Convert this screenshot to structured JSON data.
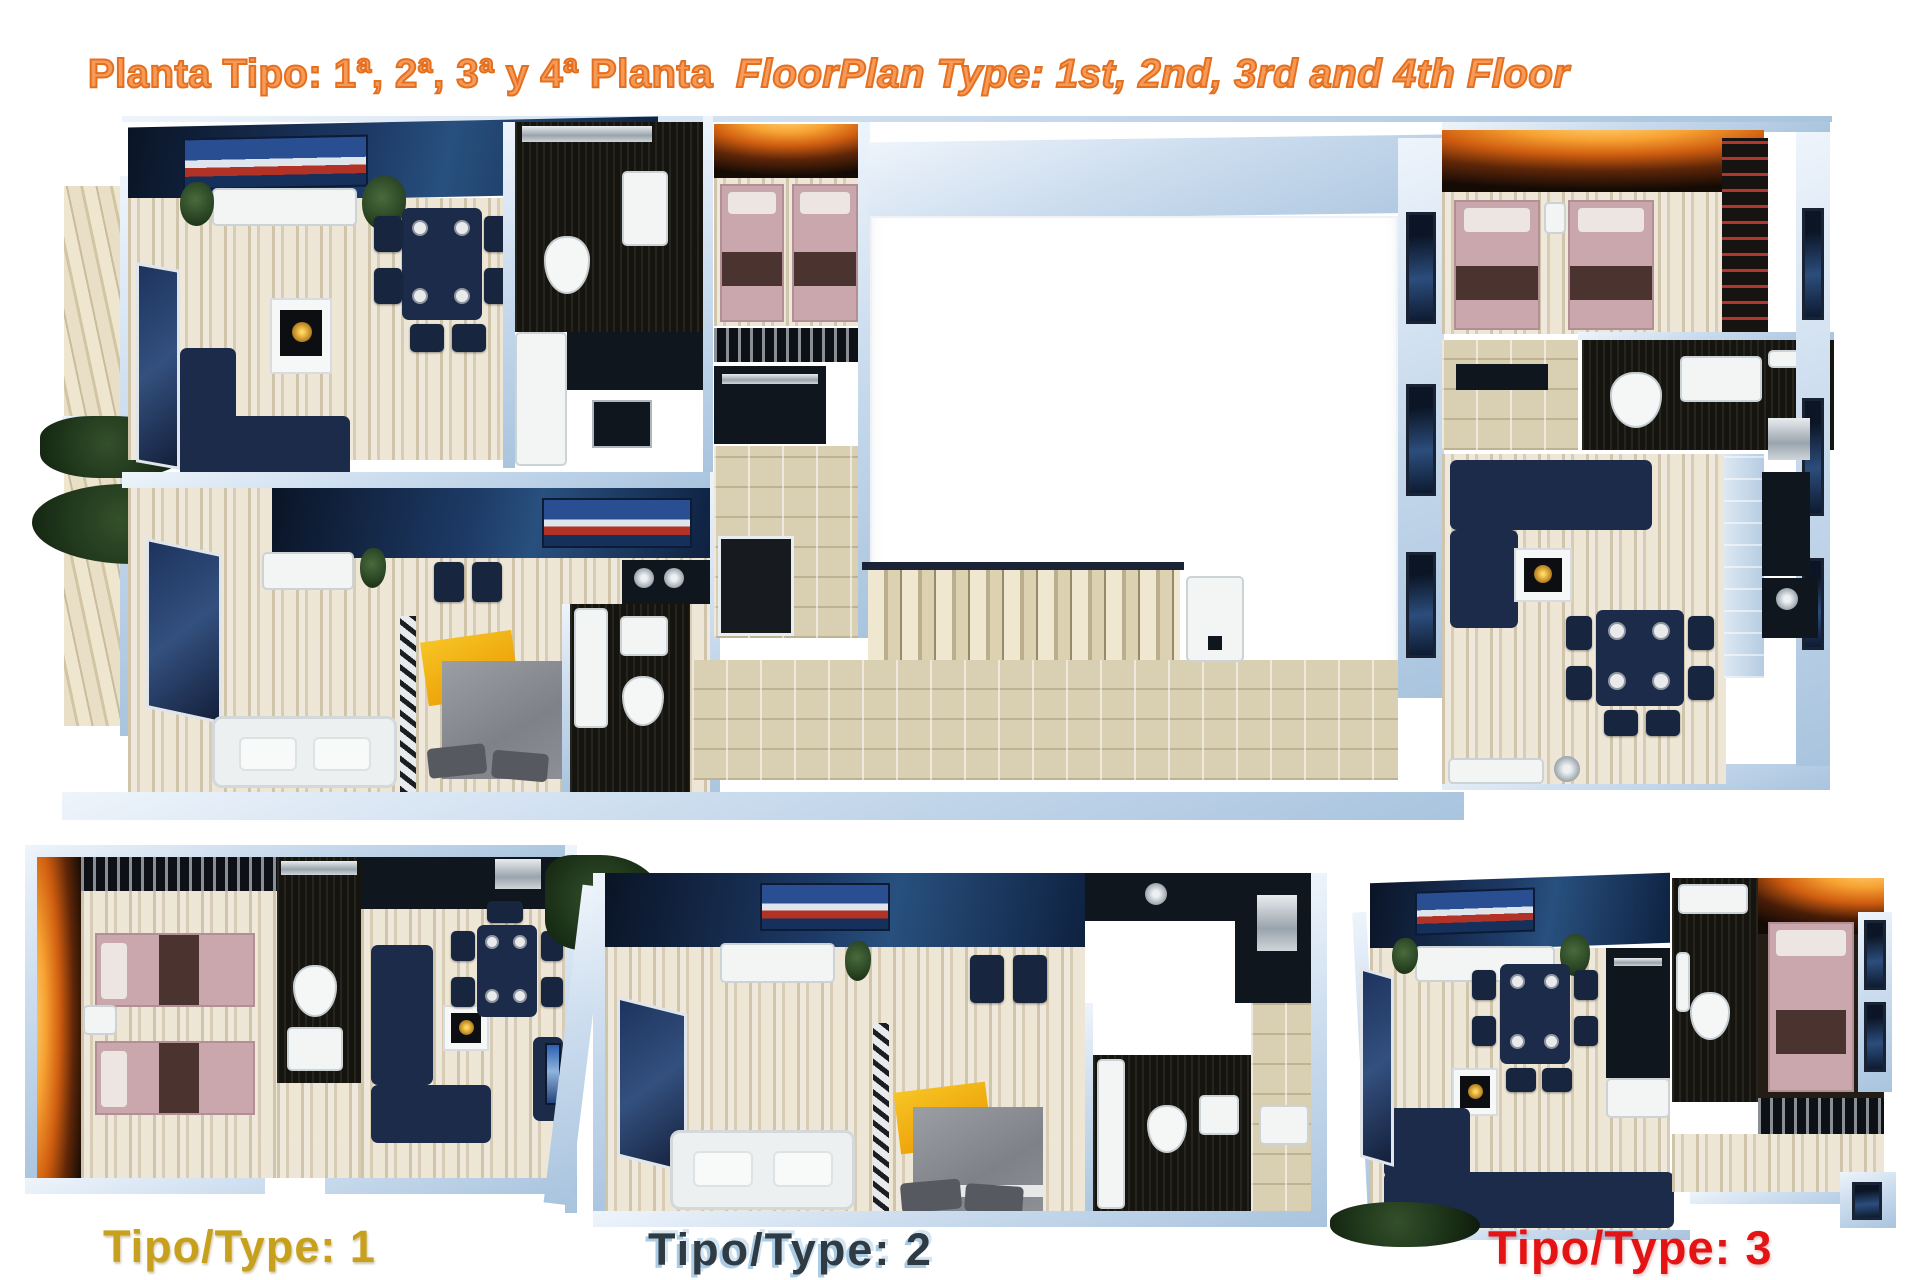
{
  "header": {
    "title_spanish": "Planta Tipo: 1ª, 2ª, 3ª y 4ª Planta",
    "title_english": "FloorPlan Type: 1st, 2nd, 3rd and 4th Floor",
    "accent_color": "#ed7c31"
  },
  "plan_labels": {
    "type1": {
      "label": "Tipo/Type: 1",
      "color": "#c7a01d"
    },
    "type2": {
      "label": "Tipo/Type: 2",
      "color": "#2f3a42"
    },
    "type3": {
      "label": "Tipo/Type: 3",
      "color": "#e51414"
    }
  },
  "palette": {
    "wall_blue": "#c9dbee",
    "floor_beige": "#e7decb",
    "furniture_navy": "#1c2b4a",
    "bed_pink": "#c9a7ad",
    "fire_glow_orange": "#f7a232",
    "bathroom_dark": "#16140e"
  }
}
